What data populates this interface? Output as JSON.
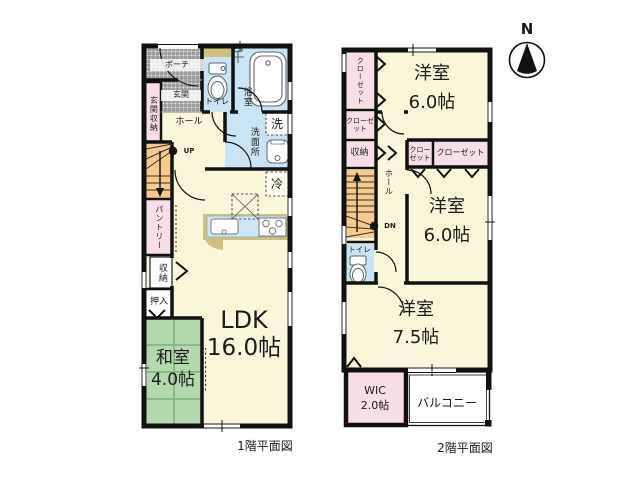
{
  "north": {
    "label": "N"
  },
  "floor1": {
    "caption": "1階平面図",
    "labels": {
      "porch": "ポーチ",
      "entrance": "玄関",
      "entrance_storage": "玄関収納",
      "toilet": "トイレ",
      "bathroom": "浴室",
      "washroom": "洗面所",
      "washer": "洗",
      "hall": "ホール",
      "up": "UP",
      "fridge": "冷",
      "pantry": "パントリー",
      "storage": "収納",
      "oshiire": "押入",
      "ldk_name": "LDK",
      "ldk_size": "16.0帖",
      "washitsu_name": "和室",
      "washitsu_size": "4.0帖"
    }
  },
  "floor2": {
    "caption": "2階平面図",
    "labels": {
      "closet_left_tall": "クローゼット",
      "closet_left_small": "クローゼット",
      "storage": "収納",
      "hall": "ホール",
      "dn": "DN",
      "toilet": "トイレ",
      "bedroom_top_name": "洋室",
      "bedroom_top_size": "6.0帖",
      "closet_mid_small": "クローゼット",
      "closet_wide": "クローゼット",
      "bedroom_mid_name": "洋室",
      "bedroom_mid_size": "6.0帖",
      "bedroom_bottom_name": "洋室",
      "bedroom_bottom_size": "7.5帖",
      "wic_name": "WIC",
      "wic_size": "2.0帖",
      "balcony": "バルコニー"
    }
  },
  "colors": {
    "wall": "#111111",
    "room_cream": "#faf6da",
    "wet_blue": "#c9e4f4",
    "storage_pink": "#f8dee6",
    "tatami_green": "#b5d9af",
    "stairs_orange": "#f7ca8e",
    "counter_tan": "#cfc080"
  }
}
